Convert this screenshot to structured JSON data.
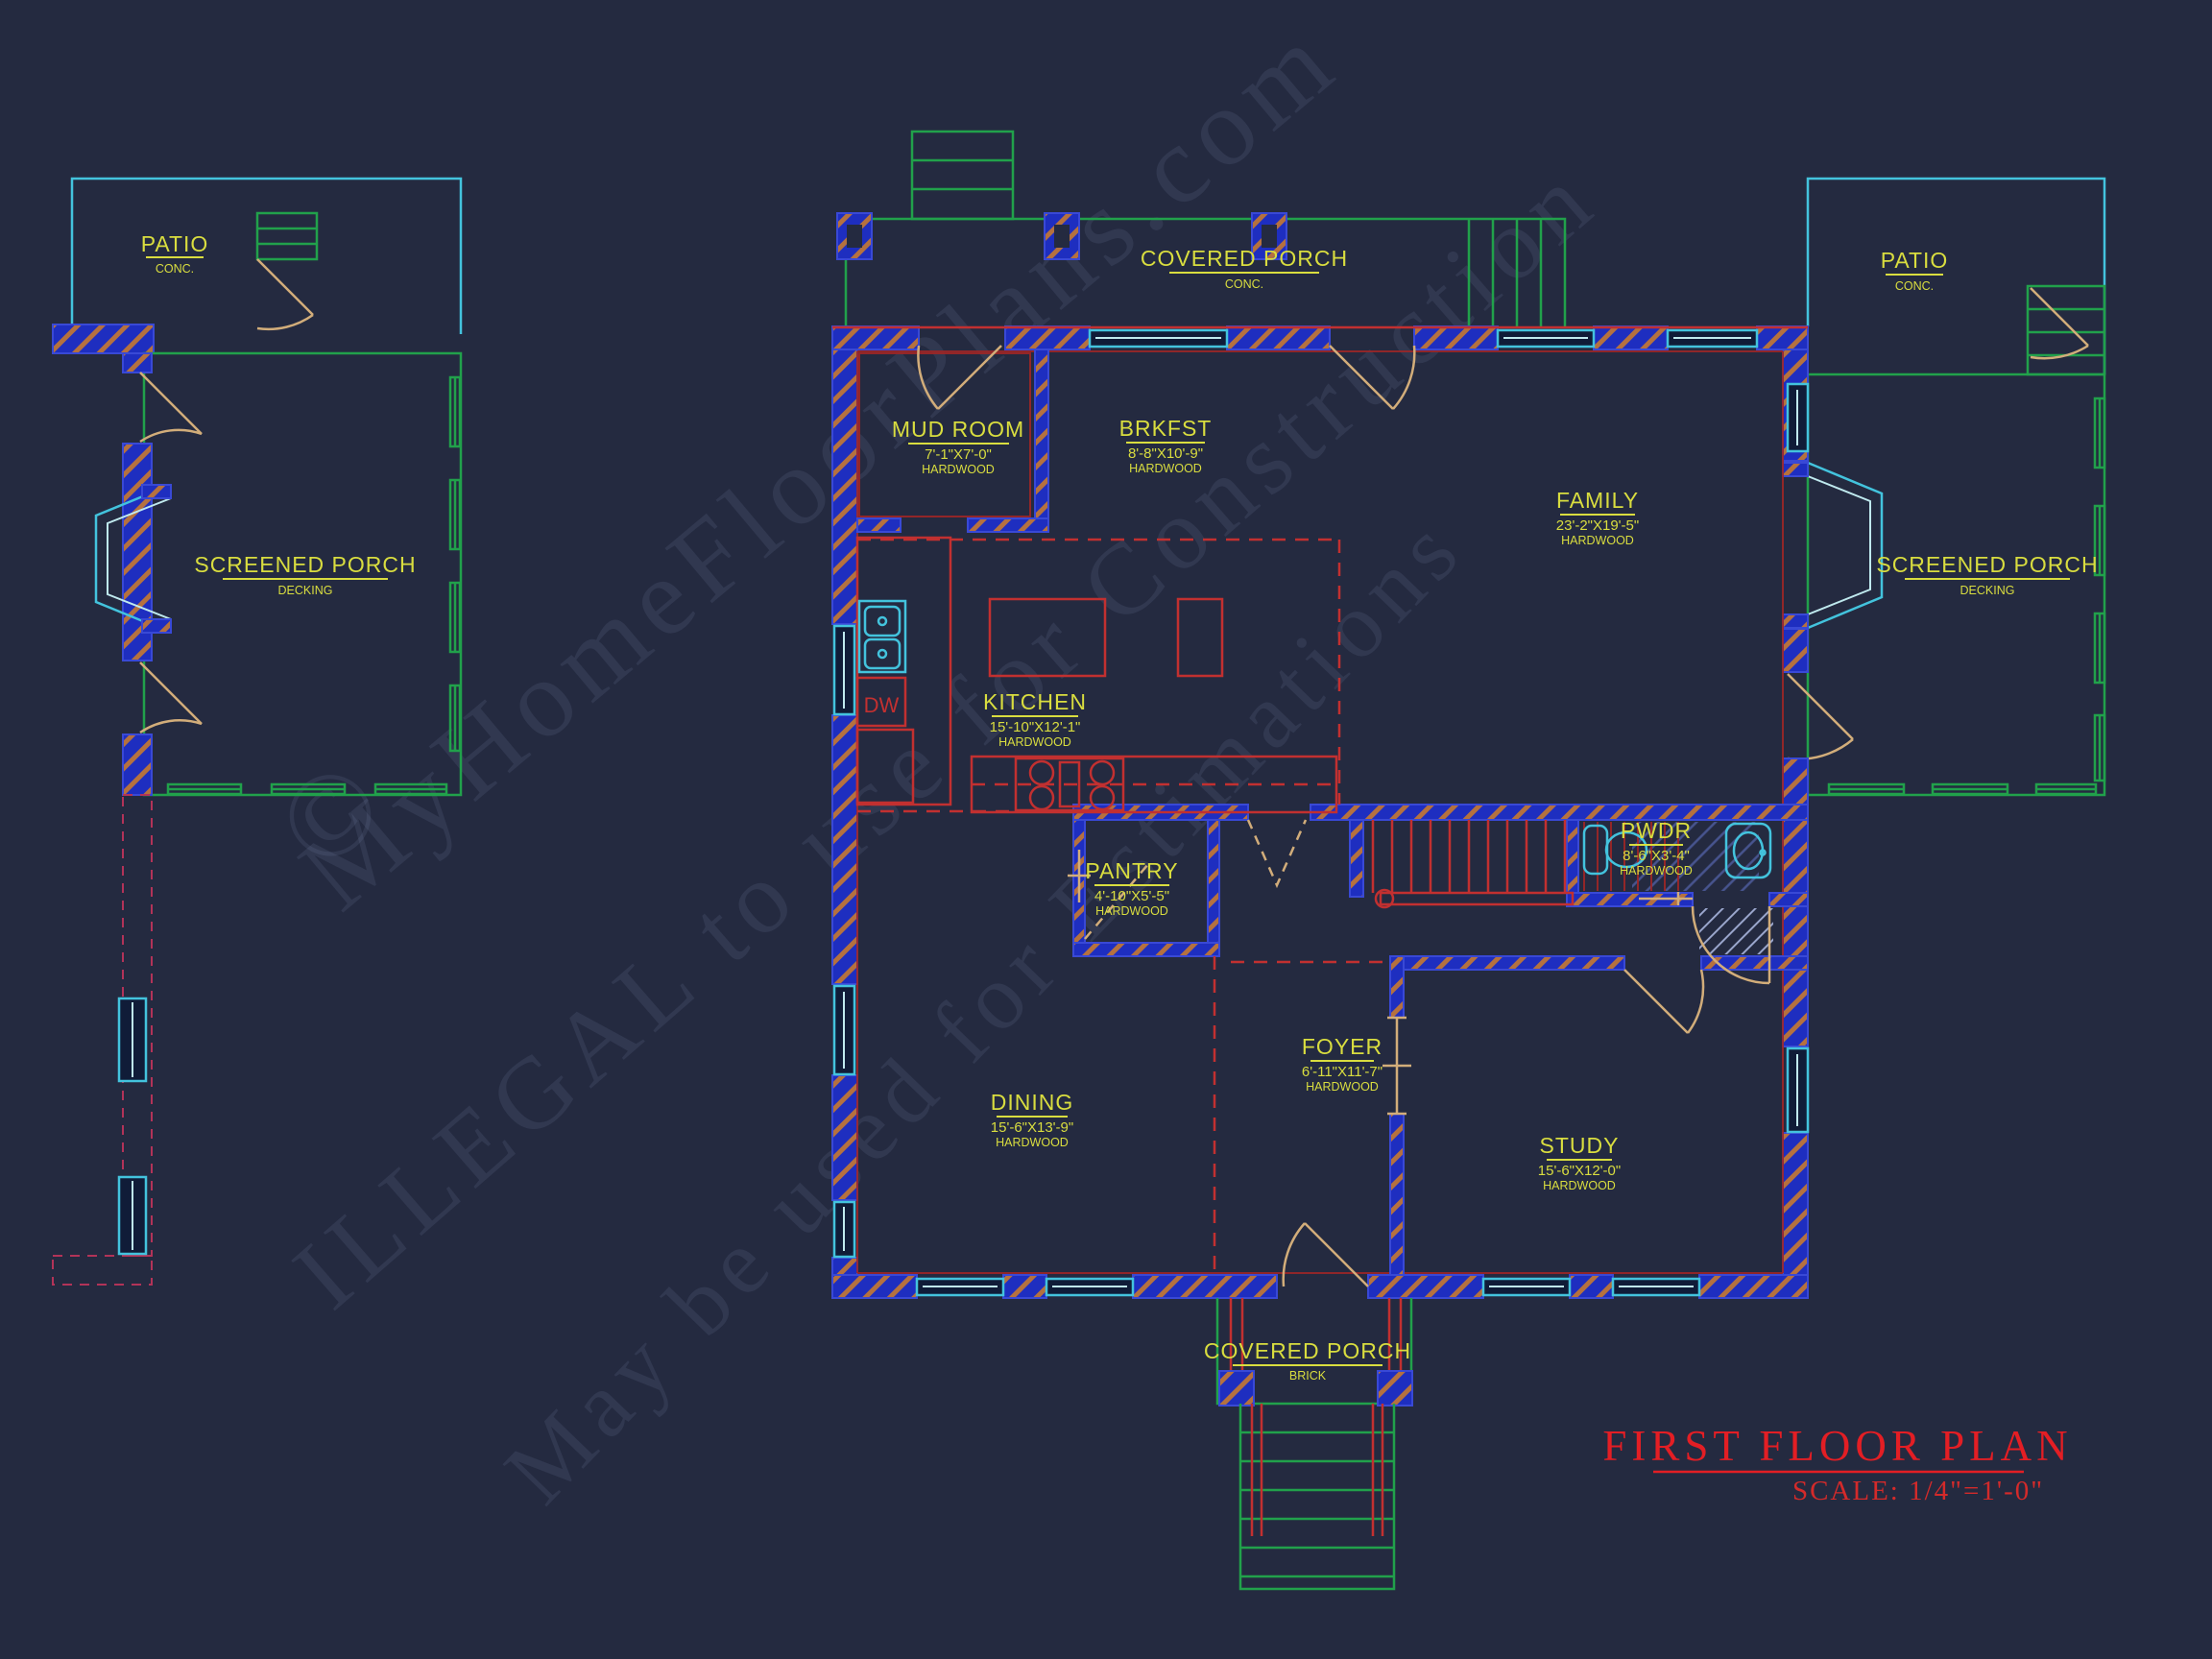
{
  "drawing": {
    "type": "floor-plan",
    "sheet_title": "FIRST FLOOR PLAN",
    "scale_note": "SCALE: 1/4\"=1'-0\""
  },
  "title": {
    "main": "FIRST FLOOR PLAN",
    "scale": "SCALE: 1/4\"=1'-0\""
  },
  "watermark": {
    "copyright": "©",
    "line1": "MyHomeFloorPlans.com",
    "line2": "ILLEGAL to use for Construction",
    "line3": "May be used for Estimations"
  },
  "rooms": {
    "patio_left": {
      "name": "PATIO",
      "floor": "CONC."
    },
    "screened_porch_left": {
      "name": "SCREENED PORCH",
      "floor": "DECKING"
    },
    "mud_room": {
      "name": "MUD ROOM",
      "dims": "7'-1\"X7'-0\"",
      "floor": "HARDWOOD"
    },
    "brkfst": {
      "name": "BRKFST",
      "dims": "8'-8\"X10'-9\"",
      "floor": "HARDWOOD"
    },
    "covered_porch_top": {
      "name": "COVERED PORCH",
      "floor": "CONC."
    },
    "patio_right": {
      "name": "PATIO",
      "floor": "CONC."
    },
    "family": {
      "name": "FAMILY",
      "dims": "23'-2\"X19'-5\"",
      "floor": "HARDWOOD"
    },
    "screened_porch_right": {
      "name": "SCREENED PORCH",
      "floor": "DECKING"
    },
    "kitchen": {
      "name": "KITCHEN",
      "dims": "15'-10\"X12'-1\"",
      "floor": "HARDWOOD"
    },
    "pwdr": {
      "name": "PWDR",
      "dims": "8'-6\"X3'-4\"",
      "floor": "HARDWOOD"
    },
    "pantry": {
      "name": "PANTRY",
      "dims": "4'-10\"X5'-5\"",
      "floor": "HARDWOOD"
    },
    "foyer": {
      "name": "FOYER",
      "dims": "6'-11\"X11'-7\"",
      "floor": "HARDWOOD"
    },
    "dining": {
      "name": "DINING",
      "dims": "15'-6\"X13'-9\"",
      "floor": "HARDWOOD"
    },
    "study": {
      "name": "STUDY",
      "dims": "15'-6\"X12'-0\"",
      "floor": "HARDWOOD"
    },
    "covered_porch_bottom": {
      "name": "COVERED PORCH",
      "floor": "BRICK"
    }
  },
  "fixtures": {
    "dishwasher": "DW"
  },
  "colors": {
    "background": "#242a40",
    "wall_blue": "#1e2ec0",
    "porch_green": "#21a14b",
    "patio_cyan": "#43c3dd",
    "label_yellow": "#d9dd3f",
    "line_red": "#c23030",
    "door_tan": "#d2ad7a",
    "title_red": "#e31e24"
  }
}
